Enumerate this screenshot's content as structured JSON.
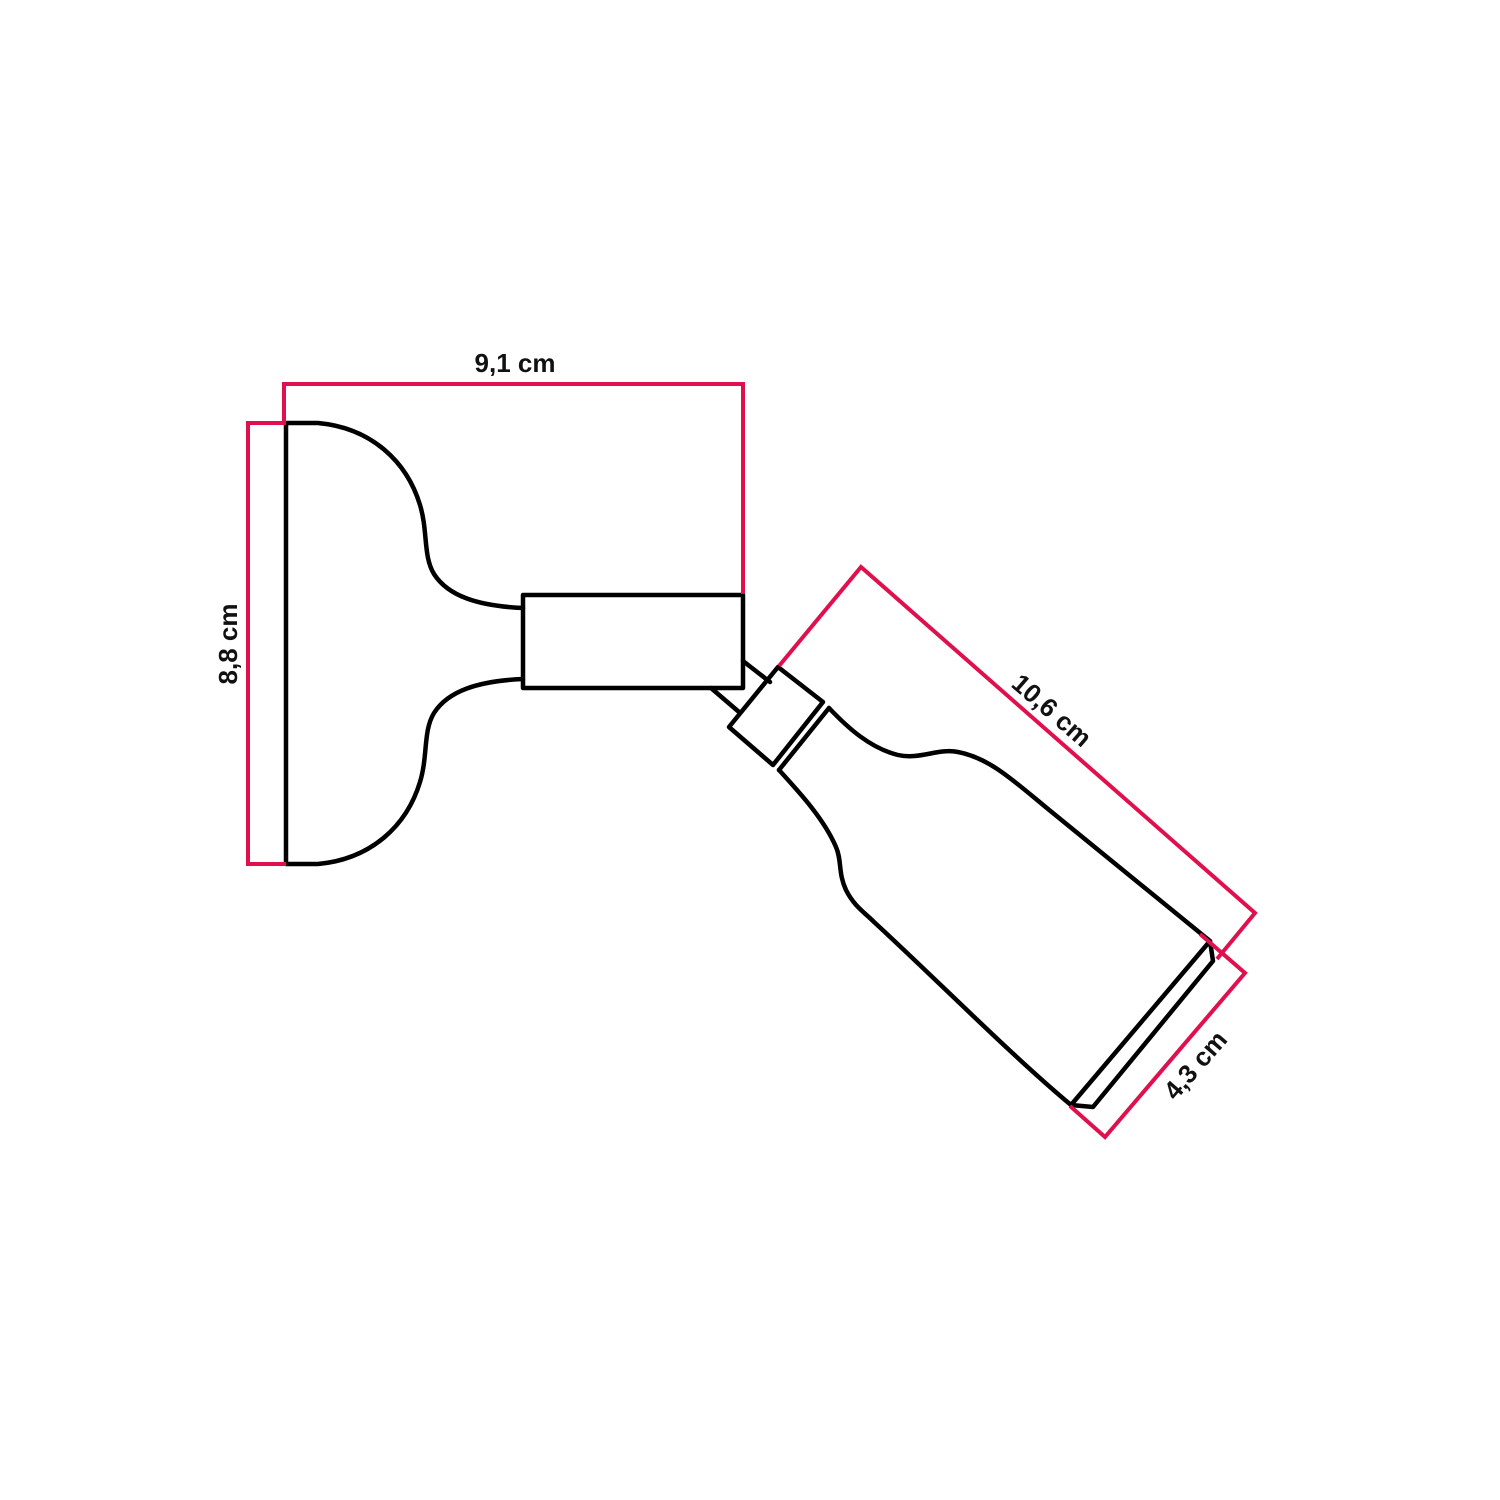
{
  "canvas": {
    "background": "#ffffff",
    "width": 1500,
    "height": 1500
  },
  "colors": {
    "accent_pink": "#E0104E",
    "outline_black": "#000000",
    "label_text": "#111111"
  },
  "diagram": {
    "unit": "cm",
    "measurements": {
      "plate_width": {
        "label": "9,1 cm",
        "value": "9,1",
        "unit": "cm"
      },
      "plate_height": {
        "label": "8,8 cm",
        "value": "8,8",
        "unit": "cm"
      },
      "body_length": {
        "label": "10,6 cm",
        "value": "10,6",
        "unit": "cm"
      },
      "body_diameter": {
        "label": "4,3 cm",
        "value": "4,3",
        "unit": "cm"
      }
    }
  }
}
